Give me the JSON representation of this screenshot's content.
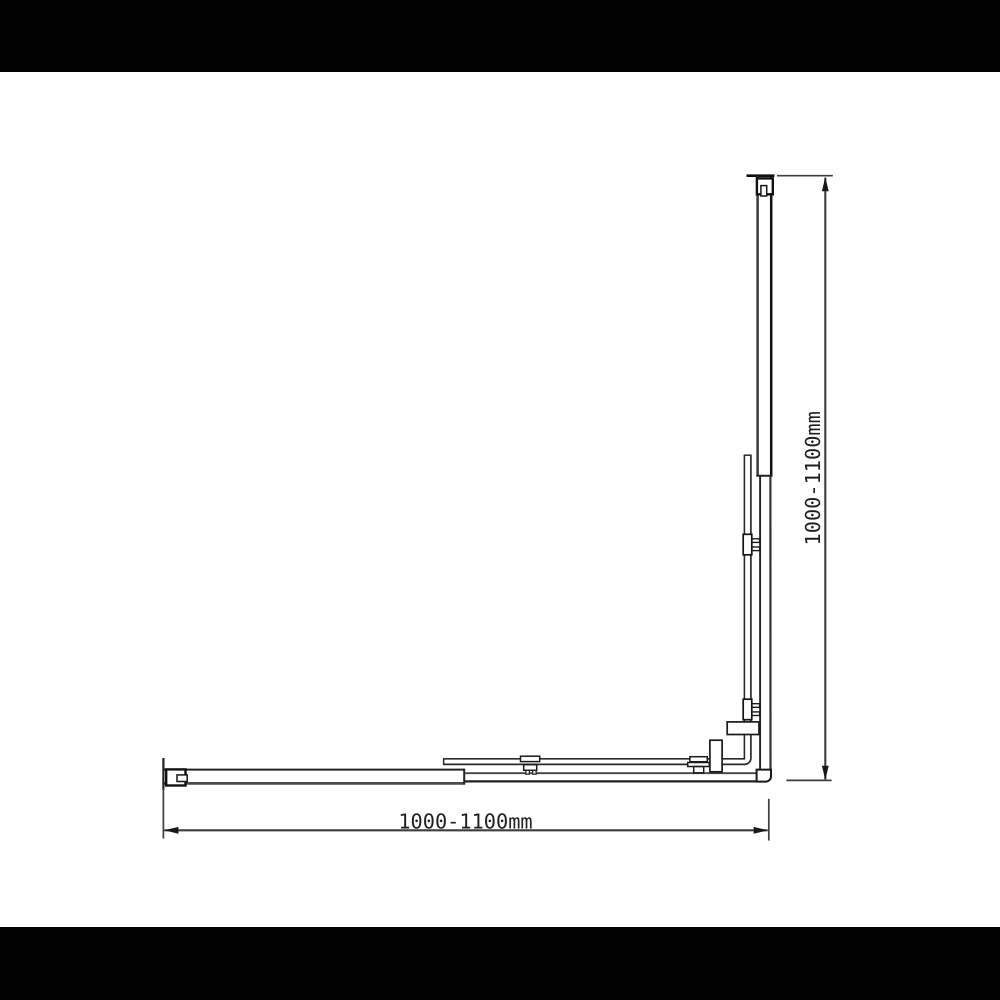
{
  "meta": {
    "type": "technical-line-drawing",
    "subject": "L-shaped corner frame with adjustable wall profiles, glass panel, clamps and dimension callouts",
    "background": "#ffffff",
    "letterbox_color": "#000000"
  },
  "dimensions": {
    "width": {
      "label": "1000-1100mm",
      "min_mm": 1000,
      "max_mm": 1100,
      "orientation": "horizontal",
      "position": "bottom"
    },
    "height": {
      "label": "1000-1100mm",
      "min_mm": 1000,
      "max_mm": 1100,
      "orientation": "vertical",
      "position": "right"
    }
  },
  "colors": {
    "line": "#222222",
    "line_strong": "#111111",
    "line_gray": "#4a4a4a",
    "dimension_line": "#3d3d3d",
    "arrow": "#181818",
    "text": "#1f1f1f"
  }
}
